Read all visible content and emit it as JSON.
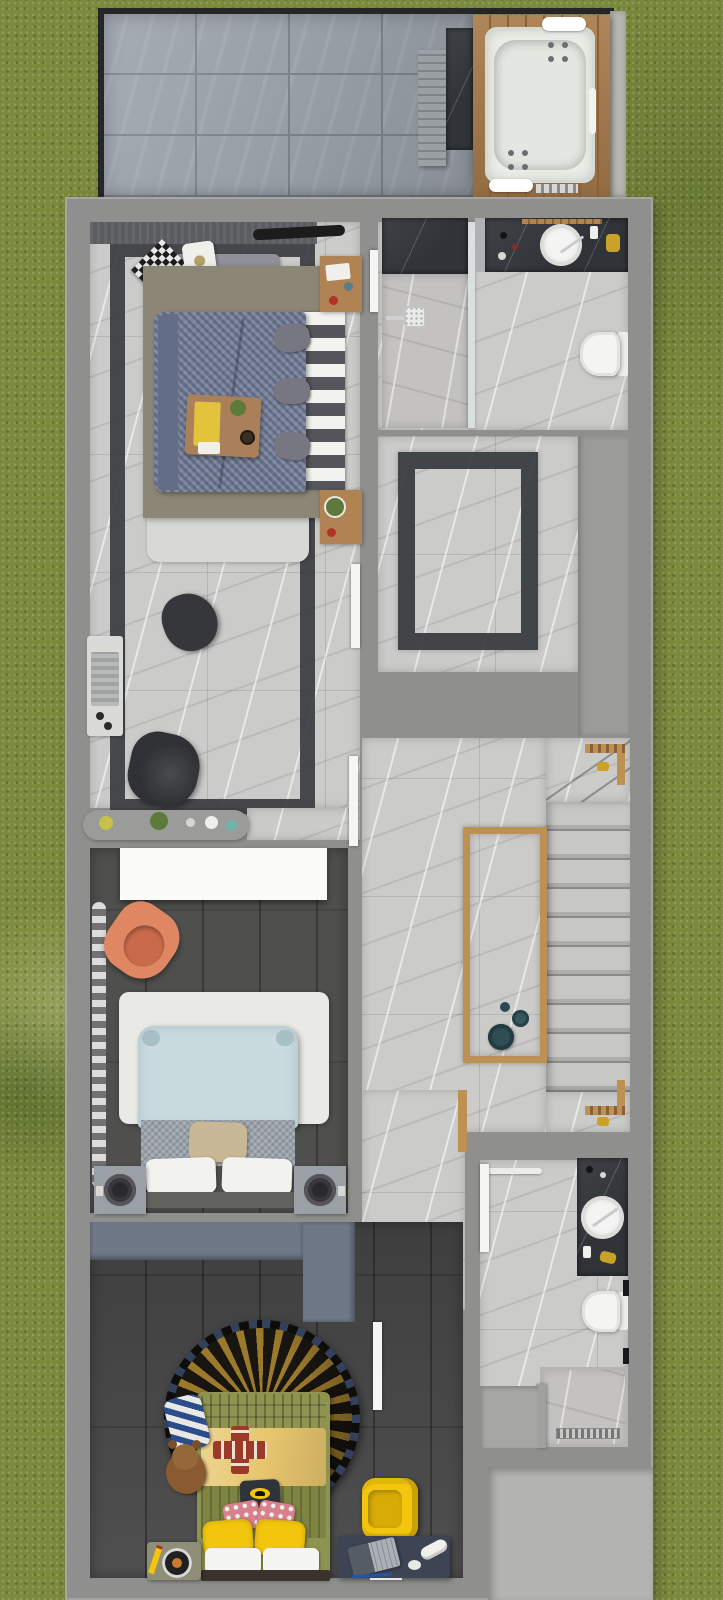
{
  "scene": {
    "type": "3d-rendered-floor-plan",
    "view": "top-down",
    "description": "upper floor plan of a house with roof terrace, surrounded by lawn"
  },
  "palette": {
    "grass": "#7b893c",
    "wall": "#8f8f8d",
    "wallLight": "#a5a5a3",
    "edgeDark": "#242628",
    "tile": "#99a0a8",
    "tileLine": "#7c838b",
    "stone": "#b7b7b2",
    "deck": "#a87b4b",
    "deckLine": "#8a6238",
    "tub": "#ebede8",
    "marble": "#cbcbc9",
    "marbleWarm": "#c3c2c0",
    "darkMarble": "#303438",
    "inlay": "#3a3d3f",
    "wood": "#b18353",
    "platform": "#8c8677",
    "duvet": "#78829b",
    "duvetDark": "#636d86",
    "benchGray": "#90909a",
    "trayWood": "#a9805a",
    "napkin": "#e3c33c",
    "rugLight": "#d8d8d4",
    "charcoal": "#2f3135",
    "consoleGray": "#9b9b99",
    "plankFloor": "#4f4f4d",
    "wardrobe": "#fbfbfa",
    "orangeChair": "#df8662",
    "orangeChairDark": "#c96b4a",
    "rug2": "#e9e9e5",
    "bed2": "#c9dbdf",
    "bed2Blanket": "#9aa3ab",
    "beige": "#c9b895",
    "nightstand2": "#9aa0a6",
    "speakerDark": "#2a2a2c",
    "kidsFloor": "#464646",
    "slate": "#6f7887",
    "rugGold": "#9c7a2c",
    "rugDark": "#191510",
    "rugTrim": "#33415c",
    "olive": "#8e9350",
    "oliveDark": "#7e8442",
    "yellowBlanket": "#e7c66e",
    "brightYellow": "#f3c60e",
    "redCross": "#9c3a2a",
    "batman": "#2e343a",
    "pink": "#d8808c",
    "desk": "#3d4454",
    "tableOlive": "#8f8f77",
    "teal": "#2f4d52",
    "gold": "#c9a227",
    "porcelain": "#f4f4f2",
    "patio": "#b3b3b1",
    "doorWhite": "#f5f5f3",
    "greenPlant": "#5d7a3a",
    "redAccent": "#b03326",
    "stripeBlue": "#2b4d8c",
    "brown": "#8a5a30"
  },
  "rooms": [
    {
      "id": "roof-terrace",
      "furniture": [
        "jacuzzi-on-wood-deck",
        "slatted-bench",
        "dark-marble-bench-slab",
        "large-format-tile-floor"
      ]
    },
    {
      "id": "master-bedroom",
      "furniture": [
        "double-bed-houndstooth-duvet",
        "striped-headboard",
        "breakfast-tray",
        "bench-with-pillows",
        "nightstand-top",
        "nightstand-bottom",
        "area-rug",
        "side-console",
        "dark-armchair",
        "floor-cushion",
        "decor-console",
        "marble-floor-with-dark-inlay-border"
      ]
    },
    {
      "id": "ensuite-bathroom",
      "furniture": [
        "walk-in-shower",
        "glass-partition",
        "dark-marble-vanity",
        "round-vessel-sink",
        "wall-hung-toilet",
        "towel-bar"
      ]
    },
    {
      "id": "dressing-hall",
      "furniture": [
        "marble-floor-with-dark-inlay-border"
      ]
    },
    {
      "id": "stair-hall",
      "furniture": [
        "staircase-with-winders",
        "stairwell-glass-rail-wood-cap",
        "decor-vases",
        "wood-handrail-posts"
      ]
    },
    {
      "id": "bedroom-2",
      "furniture": [
        "white-wardrobe",
        "wavy-silver-curtain",
        "orange-armchair",
        "white-area-rug",
        "double-bed-light-blue",
        "nightstand-left-with-speaker-lamp",
        "nightstand-right-with-speaker-lamp",
        "decor-shelf"
      ]
    },
    {
      "id": "kids-bedroom",
      "furniture": [
        "slate-wardrobe",
        "round-batman-rug",
        "single-bed-yellow",
        "red-cross-pillow",
        "batman-pillow",
        "yellow-pillows",
        "teddy-bear",
        "striped-pillow",
        "yellow-armchair",
        "desk-with-laptop-and-sneaker",
        "record-player-side-table"
      ]
    },
    {
      "id": "bathroom-2",
      "furniture": [
        "dark-marble-vanity",
        "round-vessel-sink",
        "wall-hung-toilet",
        "walk-in-shower-with-drain",
        "glass-partition",
        "towel-bar"
      ]
    },
    {
      "id": "exterior",
      "furniture": [
        "lawn",
        "patio-slab"
      ]
    }
  ]
}
